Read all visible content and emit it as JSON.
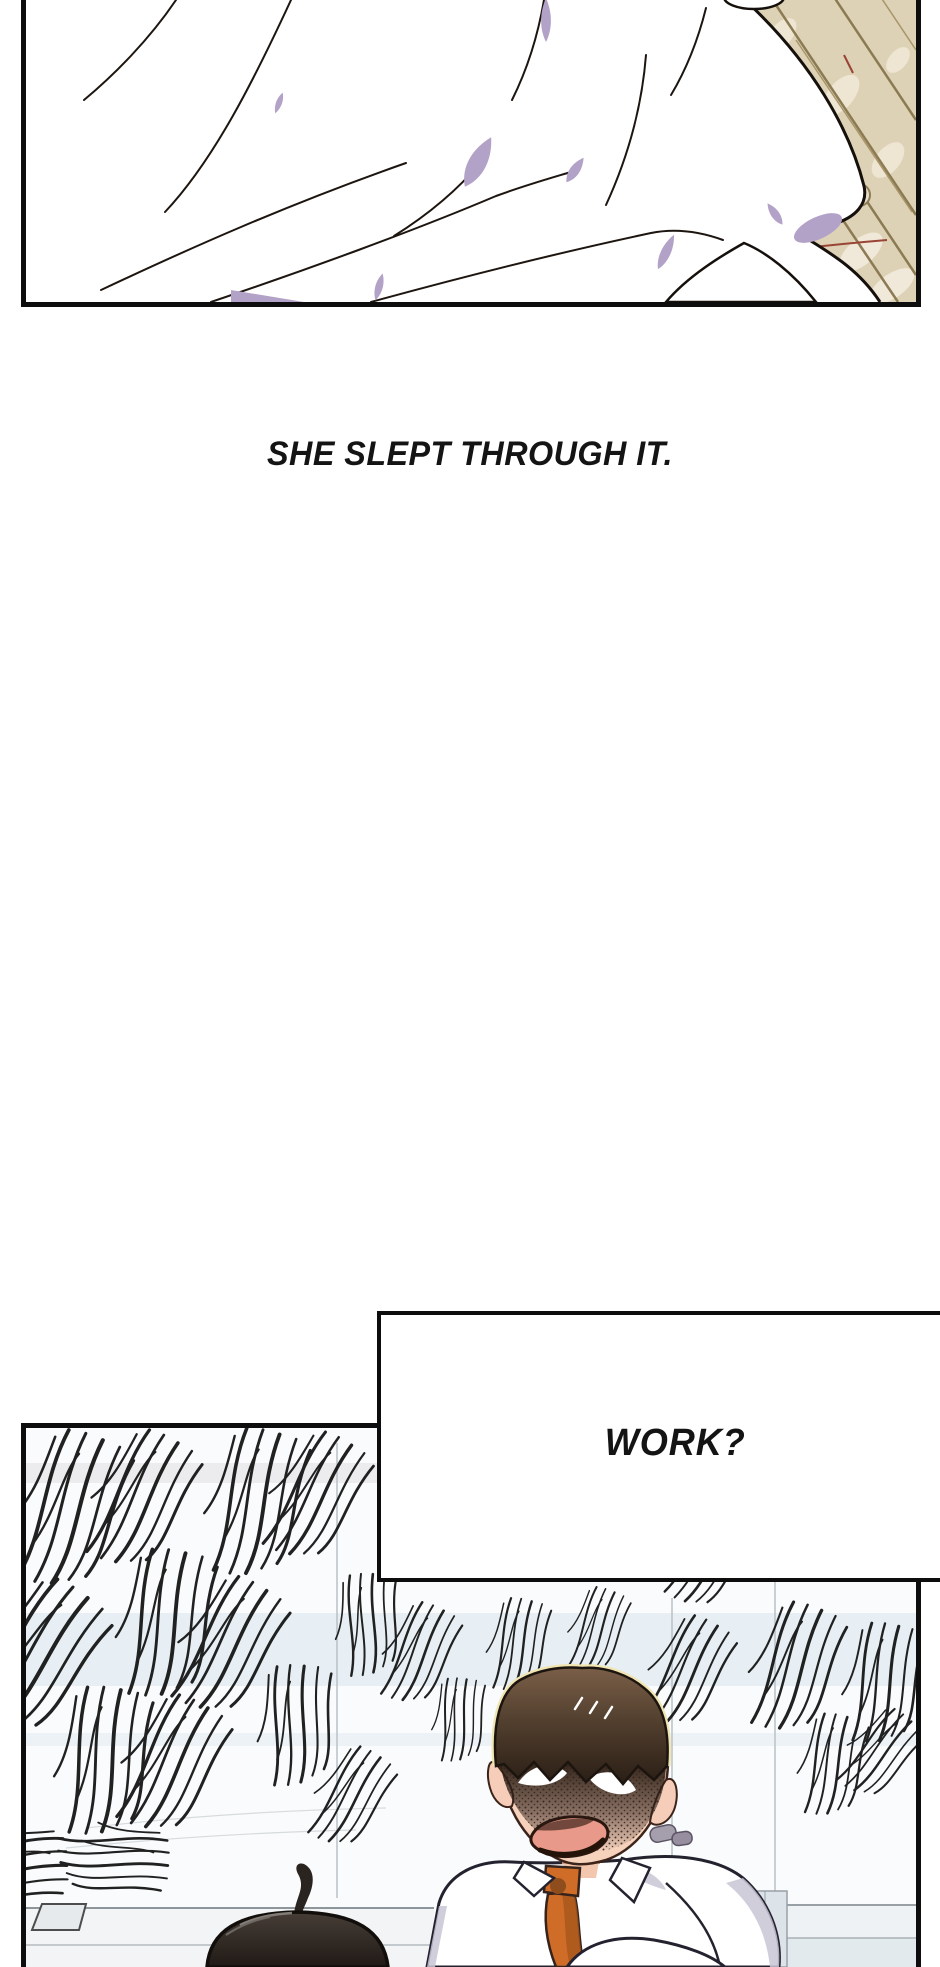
{
  "narration": {
    "text": "SHE SLEPT THROUGH IT."
  },
  "speech": {
    "text": "WORK?"
  },
  "colors": {
    "panel_border": "#0d0d0d",
    "ink": "#141414",
    "lavender_shadow": "#b3a2c7",
    "floor_beige": "#ddd2b6",
    "floor_plank_line": "#8b7a52",
    "floor_red_line": "#9a4434",
    "tie_orange": "#cf6c28",
    "hair_brown": "#4a382b",
    "hair_rim_cream": "#f1e5b2",
    "skin": "#f6d2bd",
    "mouth_pink": "#e9998a",
    "shirt_shadow": "#c9c5d6",
    "office_tint": "#e7eff5",
    "desk_gray": "#f2f4f5"
  }
}
